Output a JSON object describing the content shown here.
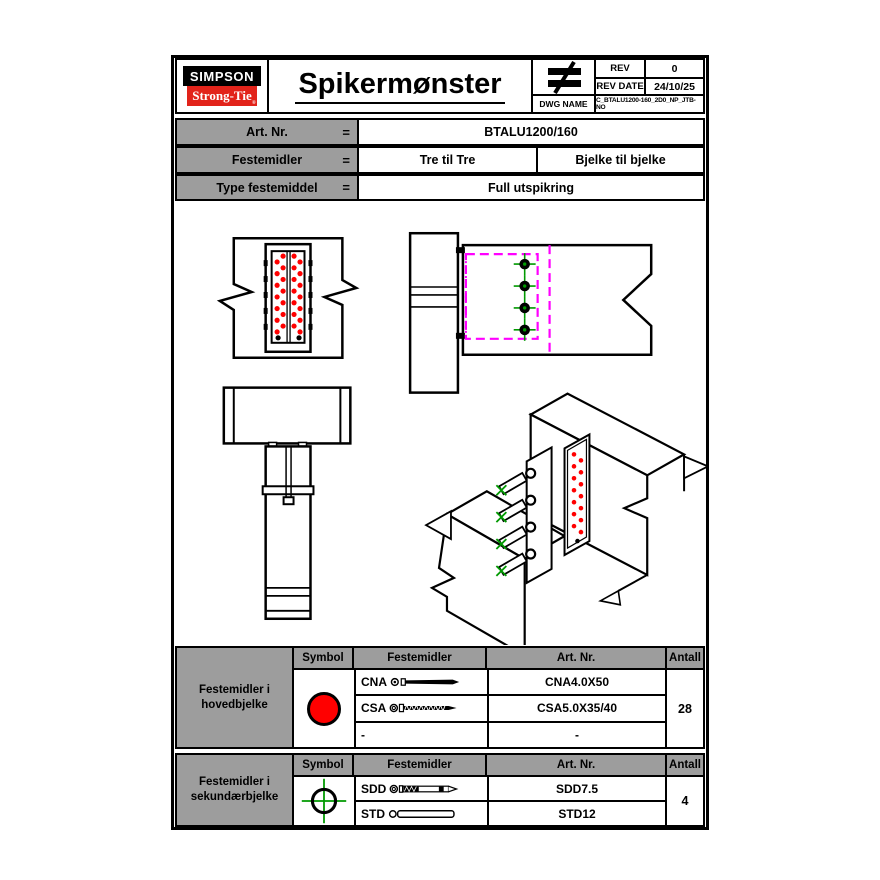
{
  "colors": {
    "brand_red": "#e2231a",
    "cell_gray": "#9d9d9d",
    "nail_red": "#ff0000",
    "dowel_green": "#009900",
    "hidden_magenta": "#ff00ff"
  },
  "header": {
    "logo": {
      "line1": "SIMPSON",
      "line2": "Strong-Tie",
      "registered": "®"
    },
    "title": "Spikermønster",
    "rev_label": "REV",
    "rev_value": "0",
    "rev_date_label": "REV DATE",
    "rev_date_value": "24/10/25",
    "dwg_name_label": "DWG NAME",
    "dwg_name_value": "C_BTALU1200-160_2D0_NP_JTB-NO"
  },
  "params": {
    "rows": [
      {
        "label": "Art. Nr.",
        "eq": "=",
        "values": [
          "BTALU1200/160"
        ]
      },
      {
        "label": "Festemidler",
        "eq": "=",
        "values": [
          "Tre til Tre",
          "Bjelke til bjelke"
        ]
      },
      {
        "label": "Type festemiddel",
        "eq": "=",
        "values": [
          "Full utspikring"
        ]
      }
    ]
  },
  "fastener_tables": [
    {
      "row_label": "Festemidler i hovedbjelke",
      "headers": [
        "Symbol",
        "Festemidler",
        "Art. Nr.",
        "Antall"
      ],
      "symbol": "red-circle",
      "rows": [
        {
          "code": "CNA",
          "art_nr": "CNA4.0X50"
        },
        {
          "code": "CSA",
          "art_nr": "CSA5.0X35/40"
        },
        {
          "code": "-",
          "art_nr": "-"
        }
      ],
      "antall": "28"
    },
    {
      "row_label": "Festemidler i sekundærbjelke",
      "headers": [
        "Symbol",
        "Festemidler",
        "Art. Nr.",
        "Antall"
      ],
      "symbol": "green-crosshair",
      "rows": [
        {
          "code": "SDD",
          "art_nr": "SDD7.5"
        },
        {
          "code": "STD",
          "art_nr": "STD12"
        }
      ],
      "antall": "4"
    }
  ],
  "drawing": {
    "main_beam_nails": 28,
    "secondary_beam_dowels": 4,
    "views": [
      "front",
      "side",
      "top",
      "isometric"
    ]
  }
}
